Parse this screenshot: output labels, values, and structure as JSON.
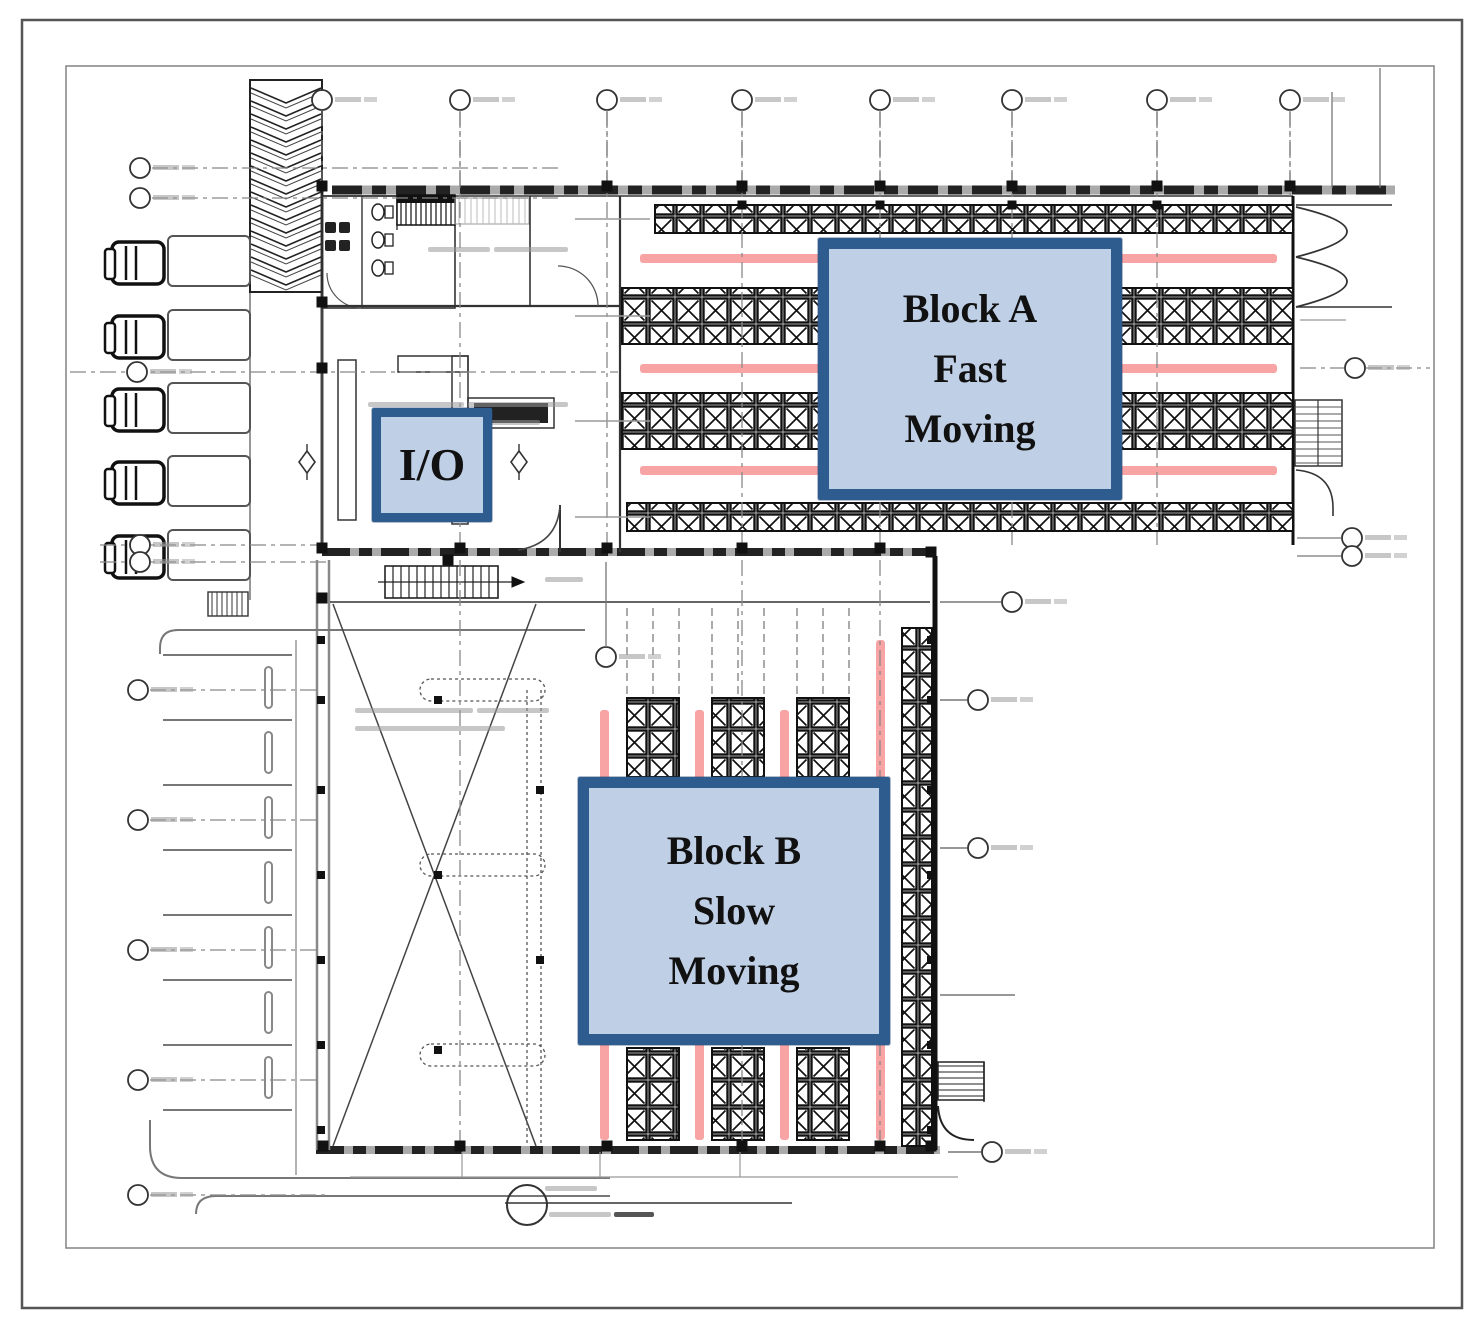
{
  "labels": {
    "block_a": {
      "line1": "Block A",
      "line2": "Fast",
      "line3": "Moving"
    },
    "block_b": {
      "line1": "Block B",
      "line2": "Slow",
      "line3": "Moving"
    },
    "io": {
      "text": "I/O"
    }
  },
  "colors": {
    "label_fill": "#BFCFE6",
    "label_border": "#2F5C8F",
    "aisle_highlight": "#F9A4A4",
    "wall_gray": "#9A9A9A",
    "line_black": "#1A1A1A"
  }
}
